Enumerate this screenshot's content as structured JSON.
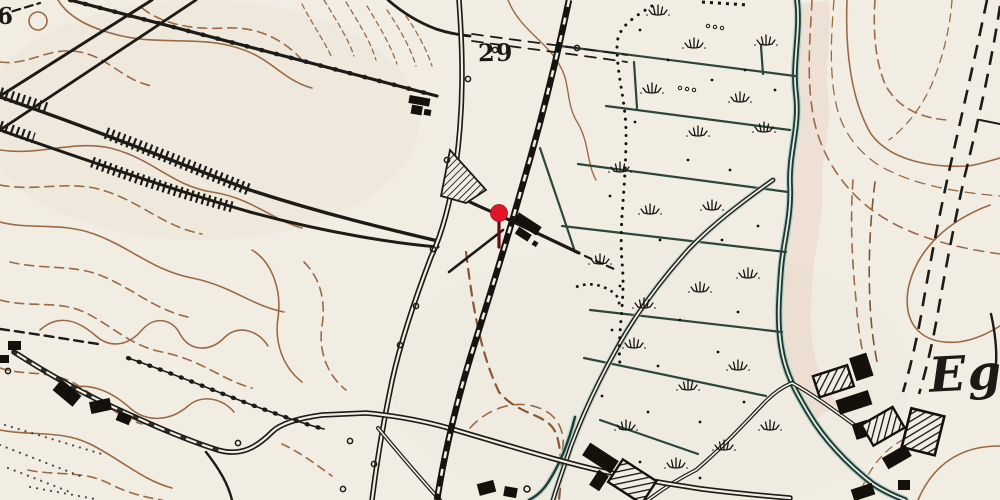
{
  "map": {
    "type": "historical-topographic-map",
    "labels": {
      "parcel_number": "29",
      "elevation_partial": "6",
      "place_name": "Eg"
    },
    "marker": {
      "name": "red-location-pin",
      "color": "#e2162a",
      "stem_color": "#5c1013"
    },
    "colors": {
      "paper": "#f2ede3",
      "ink": "#1d1b18",
      "contour_brown": "#9b6a45",
      "water_dark": "#1c3b35",
      "water_light": "#9fc4bb",
      "field_line": "#2a463e",
      "marker_red": "#e2162a"
    },
    "features": [
      "railway-line",
      "stream",
      "contour-lines",
      "roads",
      "dashed-boundary",
      "field-boundaries",
      "marsh-tufts",
      "buildings",
      "hatched-embankments",
      "plantation",
      "farmstead"
    ]
  }
}
